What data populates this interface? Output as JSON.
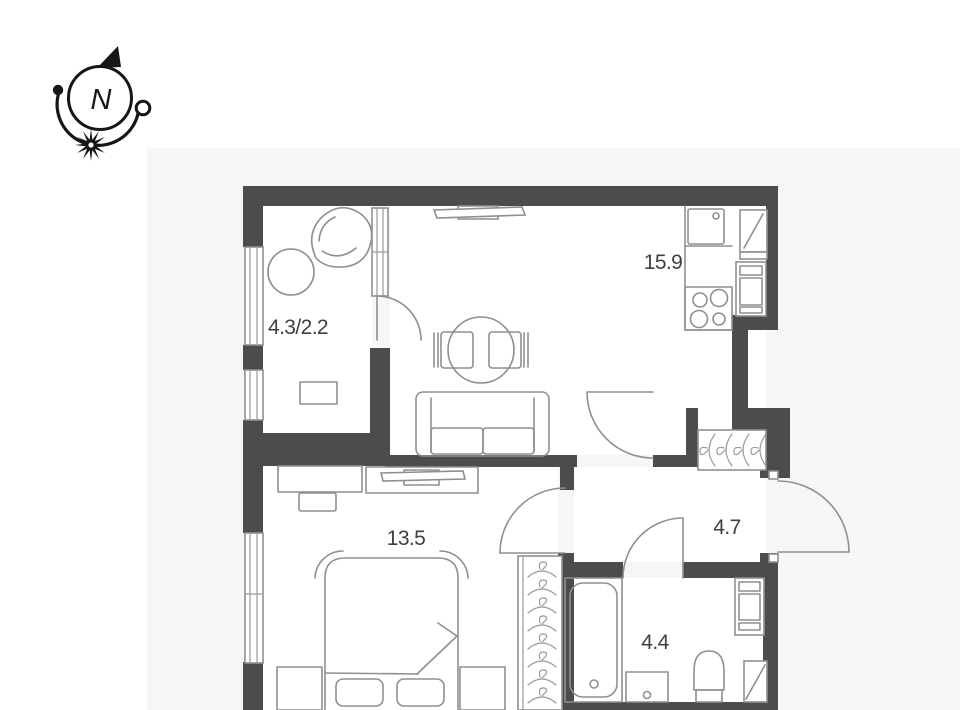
{
  "canvas": {
    "width": 960,
    "height": 710
  },
  "colors": {
    "background": "#ffffff",
    "plan_background": "#f6f6f6",
    "wall": "#4e4b4b",
    "fixture_line": "#8f8f8f",
    "label_text": "#3f3f3f",
    "compass": "#161616"
  },
  "compass": {
    "north_label": "N"
  },
  "rooms": [
    {
      "id": "loggia",
      "area_label": "4.3/2.2",
      "furniture": [
        "round-table",
        "armchair",
        "cabinet"
      ]
    },
    {
      "id": "kitchen-living-room",
      "area_label": "15.9",
      "furniture": [
        "wall-tv",
        "dining-table",
        "dining-chair",
        "dining-chair",
        "sofa",
        "kitchen-counter",
        "kitchen-sink",
        "stove",
        "fridge",
        "oven-column"
      ]
    },
    {
      "id": "bedroom",
      "area_label": "13.5",
      "furniture": [
        "desk",
        "desk-chair",
        "tv-stand",
        "double-bed",
        "pillow",
        "pillow",
        "nightstand",
        "nightstand"
      ]
    },
    {
      "id": "hallway",
      "area_label": "4.7",
      "furniture": [
        "coat-closet-hangers",
        "wardrobe-hangers",
        "entrance-door"
      ]
    },
    {
      "id": "bathroom",
      "area_label": "4.4",
      "furniture": [
        "bathtub",
        "washbasin",
        "toilet",
        "washing-machine",
        "water-heater"
      ]
    }
  ]
}
